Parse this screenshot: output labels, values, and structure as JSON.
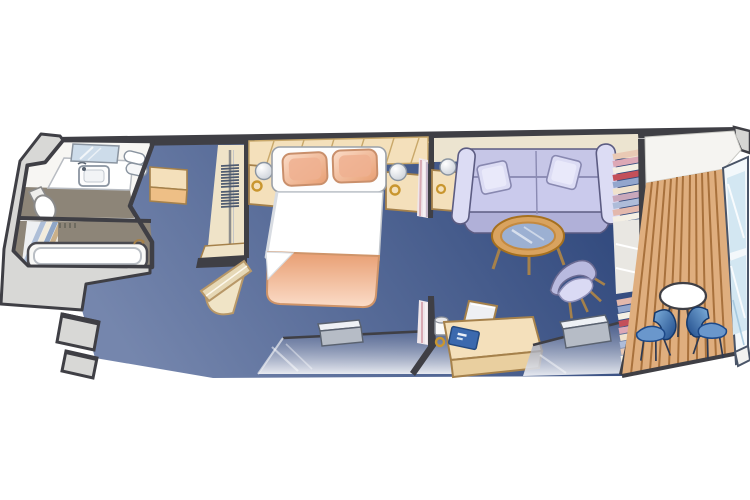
{
  "meta": {
    "title": "Stateroom floor plan",
    "description": "Isometric cruise-ship suite floor plan: bathroom with tub, wardrobe entry hall, bedroom with queen bed, sitting area with sofa and desk, and a private wood-deck balcony with table and chairs",
    "background": "#ffffff"
  },
  "colors": {
    "wall": "#3f3f45",
    "floorLight": "#7586ad",
    "floorDark": "#324a7e",
    "beige": "#f4e0bb",
    "beigeShade": "#e9cf9f",
    "orange": "#eebf86",
    "cream": "#ece4d0",
    "closetCream": "#efe3c8",
    "taupe": "#8d8578",
    "grey": "#d8d8d6",
    "mirror": "#cddcea",
    "lavender": "#c6c6e7",
    "lavenderDark": "#b0b0d8",
    "lavenderLight": "#dcdcf4",
    "slate": "#5c5c82",
    "tan": "#a5814b",
    "glassTint": "#5a6a92",
    "glassLight": "#eef0f5",
    "deck": "#dfae7e",
    "deckLine": "#a8713c",
    "railGlass": "#d3e7f2",
    "chairLight": "#7fb0dc",
    "chairDark": "#1c4888",
    "peachDark": "#e89e72",
    "peachLight": "#fbdcc8",
    "pillow": "#eeb091",
    "bookBlue": "#3b69ae",
    "gold": "#c9962f",
    "tableWood": "#d9a35f",
    "tableGlass": "#9cb0d2"
  },
  "scene": {
    "rooms": [
      {
        "name": "bathroom",
        "furniture": [
          "mirror",
          "vanity-sink",
          "towels",
          "toilet",
          "shower-curtain",
          "bathtub",
          "tub-faucet"
        ]
      },
      {
        "name": "entry-hall",
        "furniture": [
          "cabinet",
          "wardrobe-closet",
          "hanger-rod",
          "hangers",
          "entry-door"
        ]
      },
      {
        "name": "bedroom",
        "furniture": [
          "overhead-cabinet",
          "nightstand-left",
          "lamp-left",
          "queen-bed",
          "pillows",
          "duvet",
          "blanket",
          "nightstand-right",
          "lamp-right",
          "window-bench",
          "picture-window"
        ]
      },
      {
        "name": "sitting-area",
        "furniture": [
          "end-table",
          "table-lamp",
          "sofa",
          "throw-pillows",
          "coffee-table",
          "armchair",
          "desk",
          "desk-chair",
          "desk-lamp",
          "blue-folder",
          "window-bench",
          "picture-window",
          "bookshelf"
        ]
      },
      {
        "name": "balcony",
        "furniture": [
          "wood-deck",
          "round-table",
          "deck-chair-left",
          "deck-chair-right",
          "glass-railing"
        ]
      }
    ]
  }
}
